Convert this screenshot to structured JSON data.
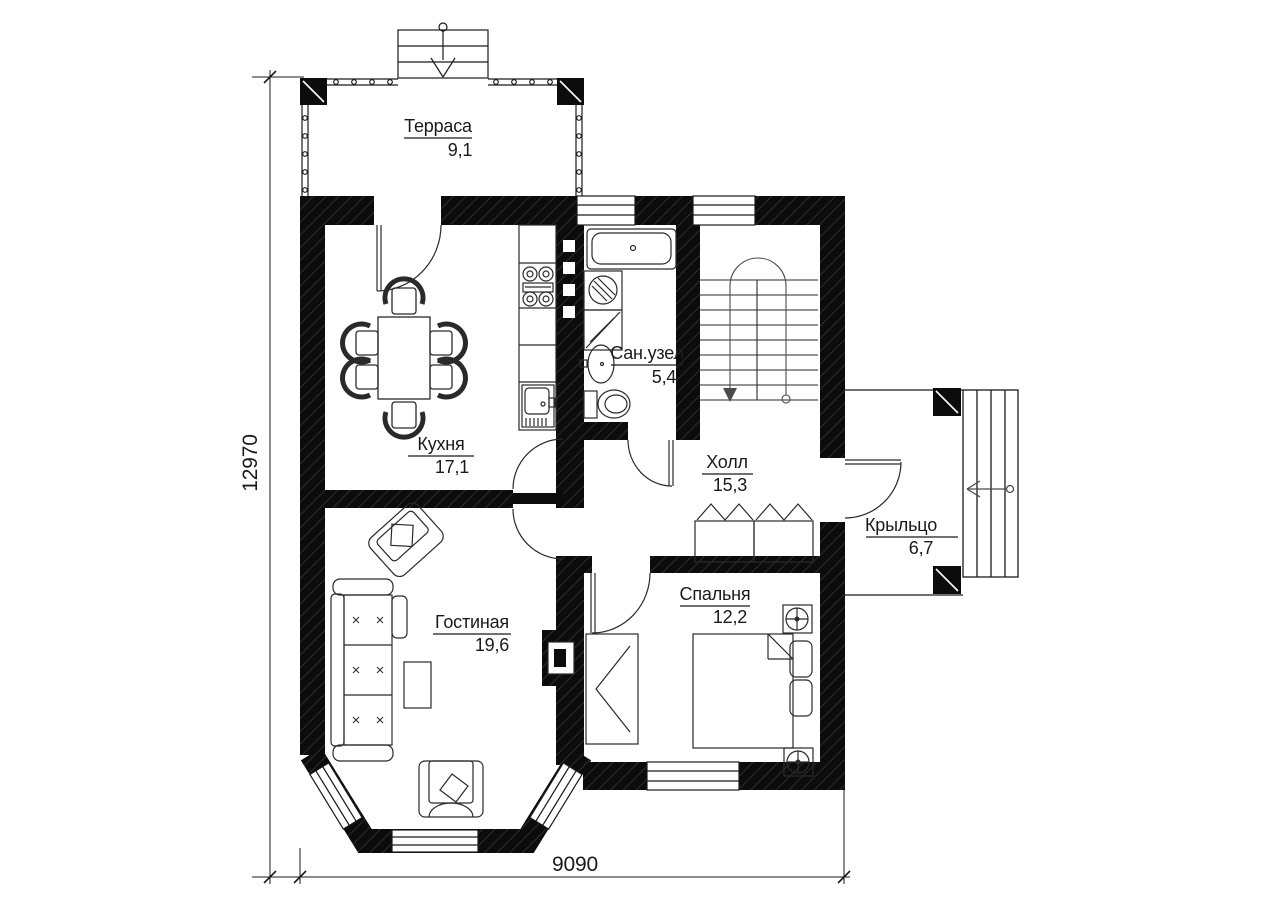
{
  "drawing": {
    "type": "floor-plan-first-floor",
    "dimensions": {
      "width_mm": "9090",
      "height_mm": "12970"
    },
    "rooms": [
      {
        "name": "Терраса",
        "area": "9,1"
      },
      {
        "name": "Кухня",
        "area": "17,1"
      },
      {
        "name": "Сан.узел",
        "area": "5,4"
      },
      {
        "name": "Холл",
        "area": "15,3"
      },
      {
        "name": "Крыльцо",
        "area": "6,7"
      },
      {
        "name": "Гостиная",
        "area": "19,6"
      },
      {
        "name": "Спальня",
        "area": "12,2"
      }
    ],
    "colors": {
      "background": "#ffffff",
      "wall": "#0c0c0c",
      "line": "#1a1a1a"
    }
  }
}
